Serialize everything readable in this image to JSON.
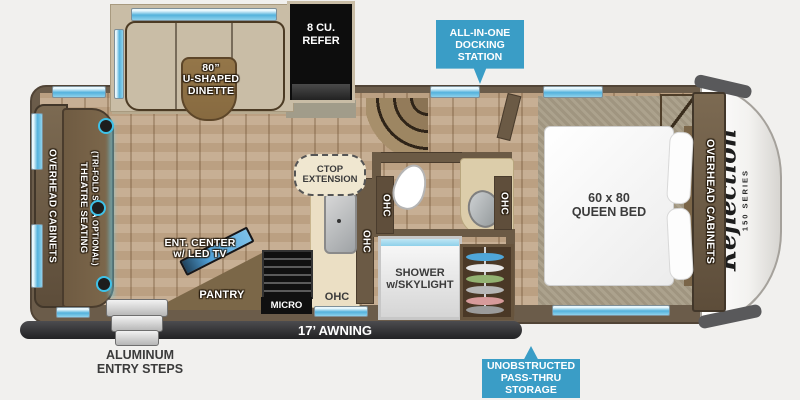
{
  "colors": {
    "callout_blue": "#3a9dc6",
    "wall_brown": "#6b5c4a",
    "floor_wood": "#c4aa8d",
    "carpet": "#a89d87",
    "awning_dark": "#2c2c2e",
    "window_blue": "#54b2dc"
  },
  "callouts": {
    "docking_station": "ALL-IN-ONE\nDOCKING\nSTATION",
    "pass_thru": "UNOBSTRUCTED\nPASS-THRU\nSTORAGE"
  },
  "slideouts": {
    "dinette": "80”\nU-SHAPED\nDINETTE",
    "refrigerator": "8 CU.\nREFER"
  },
  "living": {
    "overhead_cabinets": "OVERHEAD CABINETS",
    "theatre_seating": "THEATRE SEATING",
    "theatre_seating_sub": "(TRI-FOLD SOFA OPTIONAL)",
    "ent_center": "ENT. CENTER\nw/ LED TV",
    "pantry": "PANTRY",
    "micro": "MICRO",
    "ohc": "OHC",
    "ctop_extension": "CTOP\nEXTENSION"
  },
  "bath": {
    "shower": "SHOWER\nw/SKYLIGHT",
    "ohc": "OHC"
  },
  "bedroom": {
    "queen_bed": "60 x 80\nQUEEN BED",
    "overhead_cabinets": "OVERHEAD CABINETS"
  },
  "exterior": {
    "awning": "17’ AWNING",
    "entry_steps": "ALUMINUM\nENTRY STEPS",
    "brand": "Reflection",
    "series": "150 SERIES"
  }
}
